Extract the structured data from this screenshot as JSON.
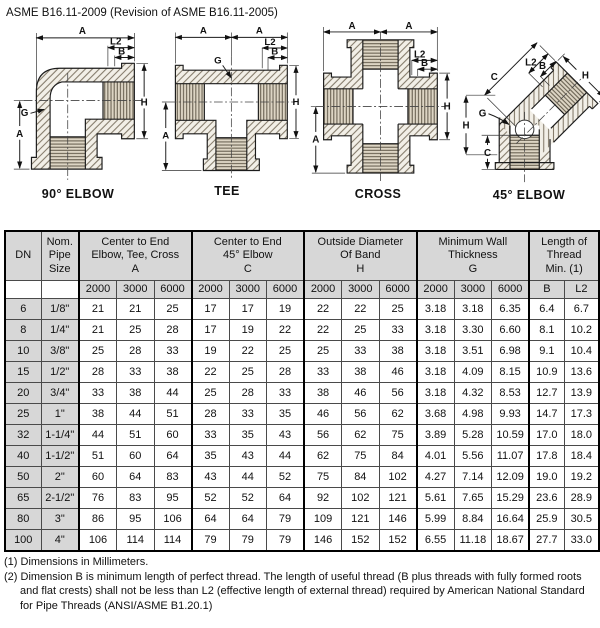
{
  "page": {
    "title": "ASME B16.11-2009 (Revision of ASME B16.11-2005)"
  },
  "figures": [
    {
      "name": "90-elbow",
      "label": "90° ELBOW",
      "dims": {
        "a_top": "A",
        "l2": "L2",
        "b": "B",
        "h": "H",
        "g": "G",
        "a_left": "A"
      }
    },
    {
      "name": "tee",
      "label": "TEE",
      "dims": {
        "a_top_left": "A",
        "a_top_right": "A",
        "l2": "L2",
        "b": "B",
        "g": "G",
        "h": "H",
        "a_left": "A"
      }
    },
    {
      "name": "cross",
      "label": "CROSS",
      "dims": {
        "a_top_left": "A",
        "a_top_right": "A",
        "l2": "L2",
        "b": "B",
        "h": "H",
        "a_left": "A"
      }
    },
    {
      "name": "45-elbow",
      "label": "45° ELBOW",
      "dims": {
        "c_arm": "C",
        "l2": "L2",
        "b": "B",
        "h_arm": "H",
        "g": "G",
        "h_left": "H",
        "c_left": "C"
      }
    }
  ],
  "table": {
    "col_headers": {
      "dn": "DN",
      "pipe_lines": [
        "Nom.",
        "Pipe",
        "Size"
      ],
      "groups": [
        {
          "lines": [
            "Center to End",
            "Elbow, Tee, Cross",
            "A"
          ],
          "subcols": [
            "2000",
            "3000",
            "6000"
          ]
        },
        {
          "lines": [
            "Center to End",
            "45° Elbow",
            "C"
          ],
          "subcols": [
            "2000",
            "3000",
            "6000"
          ]
        },
        {
          "lines": [
            "Outside Diameter",
            "Of Band",
            "H"
          ],
          "subcols": [
            "2000",
            "3000",
            "6000"
          ]
        },
        {
          "lines": [
            "Minimum Wall",
            "Thickness",
            "G"
          ],
          "subcols": [
            "2000",
            "3000",
            "6000"
          ]
        },
        {
          "lines": [
            "Length of",
            "Thread",
            "Min. (1)"
          ],
          "subcols": [
            "B",
            "L2"
          ]
        }
      ]
    },
    "rows": [
      {
        "dn": "6",
        "pipe": "1/8\"",
        "values": [
          "21",
          "21",
          "25",
          "17",
          "17",
          "19",
          "22",
          "22",
          "25",
          "3.18",
          "3.18",
          "6.35",
          "6.4",
          "6.7"
        ]
      },
      {
        "dn": "8",
        "pipe": "1/4\"",
        "values": [
          "21",
          "25",
          "28",
          "17",
          "19",
          "22",
          "22",
          "25",
          "33",
          "3.18",
          "3.30",
          "6.60",
          "8.1",
          "10.2"
        ]
      },
      {
        "dn": "10",
        "pipe": "3/8\"",
        "values": [
          "25",
          "28",
          "33",
          "19",
          "22",
          "25",
          "25",
          "33",
          "38",
          "3.18",
          "3.51",
          "6.98",
          "9.1",
          "10.4"
        ]
      },
      {
        "dn": "15",
        "pipe": "1/2\"",
        "values": [
          "28",
          "33",
          "38",
          "22",
          "25",
          "28",
          "33",
          "38",
          "46",
          "3.18",
          "4.09",
          "8.15",
          "10.9",
          "13.6"
        ]
      },
      {
        "dn": "20",
        "pipe": "3/4\"",
        "values": [
          "33",
          "38",
          "44",
          "25",
          "28",
          "33",
          "38",
          "46",
          "56",
          "3.18",
          "4.32",
          "8.53",
          "12.7",
          "13.9"
        ]
      },
      {
        "dn": "25",
        "pipe": "1\"",
        "values": [
          "38",
          "44",
          "51",
          "28",
          "33",
          "35",
          "46",
          "56",
          "62",
          "3.68",
          "4.98",
          "9.93",
          "14.7",
          "17.3"
        ]
      },
      {
        "dn": "32",
        "pipe": "1-1/4\"",
        "values": [
          "44",
          "51",
          "60",
          "33",
          "35",
          "43",
          "56",
          "62",
          "75",
          "3.89",
          "5.28",
          "10.59",
          "17.0",
          "18.0"
        ]
      },
      {
        "dn": "40",
        "pipe": "1-1/2\"",
        "values": [
          "51",
          "60",
          "64",
          "35",
          "43",
          "44",
          "62",
          "75",
          "84",
          "4.01",
          "5.56",
          "11.07",
          "17.8",
          "18.4"
        ]
      },
      {
        "dn": "50",
        "pipe": "2\"",
        "values": [
          "60",
          "64",
          "83",
          "43",
          "44",
          "52",
          "75",
          "84",
          "102",
          "4.27",
          "7.14",
          "12.09",
          "19.0",
          "19.2"
        ]
      },
      {
        "dn": "65",
        "pipe": "2-1/2\"",
        "values": [
          "76",
          "83",
          "95",
          "52",
          "52",
          "64",
          "92",
          "102",
          "121",
          "5.61",
          "7.65",
          "15.29",
          "23.6",
          "28.9"
        ]
      },
      {
        "dn": "80",
        "pipe": "3\"",
        "values": [
          "86",
          "95",
          "106",
          "64",
          "64",
          "79",
          "109",
          "121",
          "146",
          "5.99",
          "8.84",
          "16.64",
          "25.9",
          "30.5"
        ]
      },
      {
        "dn": "100",
        "pipe": "4\"",
        "values": [
          "106",
          "114",
          "114",
          "79",
          "79",
          "79",
          "146",
          "152",
          "152",
          "6.55",
          "11.18",
          "18.67",
          "27.7",
          "33.0"
        ]
      }
    ]
  },
  "footnotes": [
    "(1) Dimensions in Millimeters.",
    "(2) Dimension B is minimum length of perfect thread.  The length of useful thread (B plus threads with fully formed roots and flat crests) shall not be less than L2 (effective length of external thread) required by American National Standard for Pipe Threads (ANSI/ASME B1.20.1)"
  ]
}
